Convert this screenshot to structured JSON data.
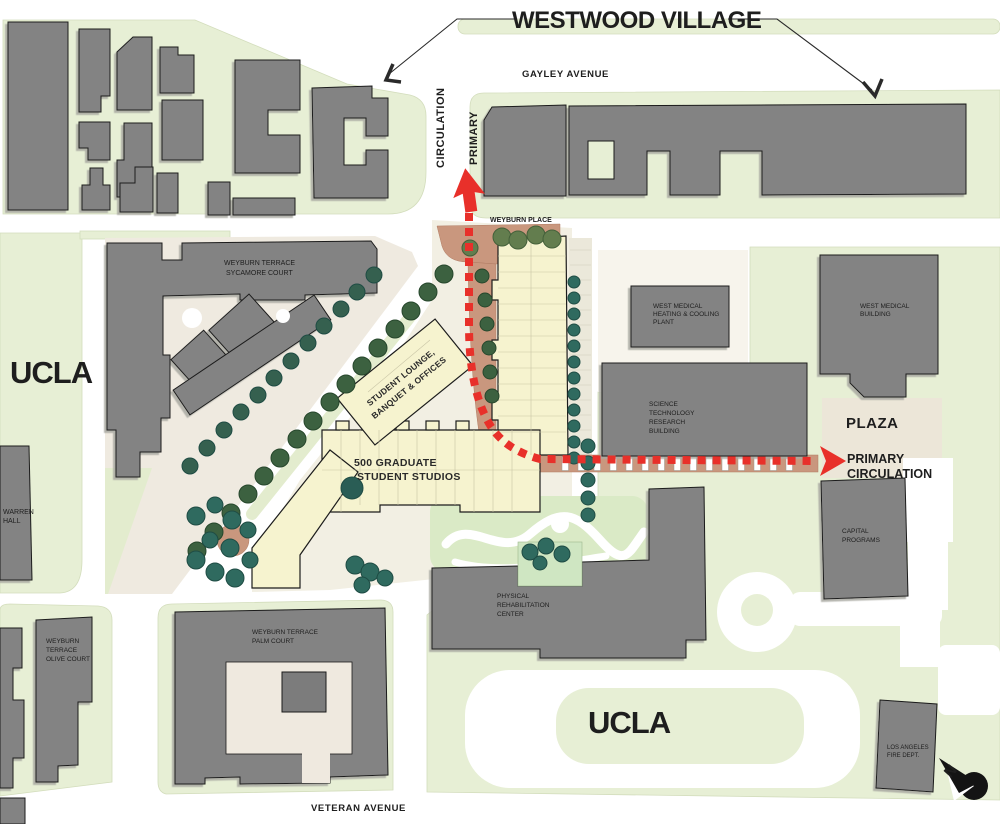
{
  "title": "WESTWOOD VILLAGE",
  "streets": {
    "gayley": "GAYLEY AVENUE",
    "weyburn_place": "WEYBURN PLACE",
    "veteran": "VETERAN AVENUE"
  },
  "campus": {
    "left": "UCLA",
    "bottom": "UCLA"
  },
  "circulation": {
    "vertical": [
      "PRIMARY",
      "CIRCULATION"
    ],
    "horizontal": [
      "PRIMARY",
      "CIRCULATION"
    ]
  },
  "buildings": {
    "sycamore": [
      "WEYBURN TERRACE",
      "SYCAMORE COURT"
    ],
    "student_lounge": [
      "STUDENT LOUNGE,",
      "BANQUET & OFFICES"
    ],
    "studios": [
      "500 GRADUATE",
      "STUDENT STUDIOS"
    ],
    "west_medical_plant": [
      "WEST MEDICAL",
      "HEATING & COOLING",
      "PLANT"
    ],
    "west_medical_building": [
      "WEST MEDICAL",
      "BUILDING"
    ],
    "science": [
      "SCIENCE",
      "TECHNOLOGY",
      "RESEARCH",
      "BUILDING"
    ],
    "plaza": "PLAZA",
    "capital": [
      "CAPITAL",
      "PROGRAMS"
    ],
    "warren": [
      "WARREN",
      "HALL"
    ],
    "rehab": [
      "PHYSICAL",
      "REHABILITATION",
      "CENTER"
    ],
    "olive": [
      "WEYBURN",
      "TERRACE",
      "OLIVE COURT"
    ],
    "palm": [
      "WEYBURN TERRACE",
      "PALM COURT"
    ],
    "fire": [
      "LOS ANGELES",
      "FIRE DEPT."
    ]
  },
  "compass": {
    "north": "N"
  },
  "colors": {
    "accent_red": "#e8302a",
    "land_green": "#e7efd5",
    "building_gray": "#838383",
    "housing_cream": "#f6f3cf",
    "brick": "#c9977e"
  }
}
